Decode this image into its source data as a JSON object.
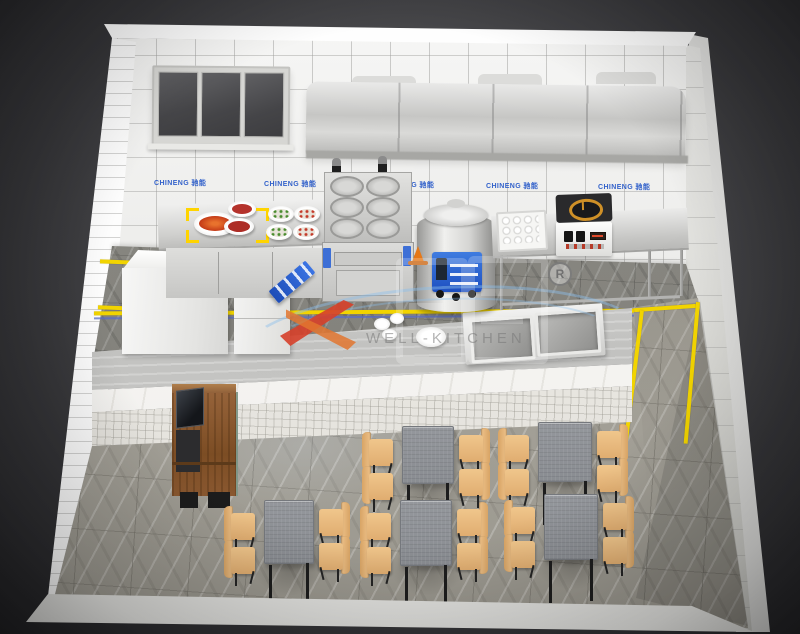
{
  "scene": {
    "type": "3d-kitchen-floorplan-rendering",
    "description": "Isometric 3D rendering of a commercial fast-food restaurant kitchen with serving counter and dining area",
    "areas": [
      "kitchen",
      "serving-counter",
      "dining-area"
    ]
  },
  "branding": {
    "watermark_text": "WELL-KITCHEN",
    "registered_symbol": "R",
    "wall_banner_label": "CHINENG 驰能",
    "wall_banner_count": 5
  },
  "kitchen": {
    "equipment": [
      {
        "name": "window",
        "panes": 3
      },
      {
        "name": "exhaust-hood"
      },
      {
        "name": "prep-table",
        "items": [
          "crayfish-plate",
          "meat-plates",
          "salad-bowls"
        ]
      },
      {
        "name": "noodle-cooker",
        "baskets": 6
      },
      {
        "name": "wet-floor-sign"
      },
      {
        "name": "soup-kettle",
        "knobs": 3
      },
      {
        "name": "safety-cone"
      },
      {
        "name": "steamer-tray-table"
      },
      {
        "name": "induction-cooker"
      },
      {
        "name": "refrigerator-cabinet"
      },
      {
        "name": "prep-cabinet"
      },
      {
        "name": "service-counter",
        "items": [
          "bowls",
          "double-sink"
        ]
      }
    ],
    "floor_marking_color": "#f2d400"
  },
  "dining": {
    "cashier_station": {
      "has_pos_monitor": true
    },
    "tables": {
      "count": 5,
      "chairs_per_table": 4,
      "top_color": "#8f9297",
      "chair_color": "#eac189"
    }
  },
  "palette": {
    "background": "#2a2a2e",
    "wall_tile": "#f0f0ef",
    "kitchen_floor": "#84837d",
    "dining_floor": "#aaa79e",
    "stainless": "#d6d6d6",
    "accent_yellow": "#f2d400",
    "accent_blue": "#2f66da",
    "swoosh_red": "#d6402a",
    "wood": "#7d4f26"
  }
}
